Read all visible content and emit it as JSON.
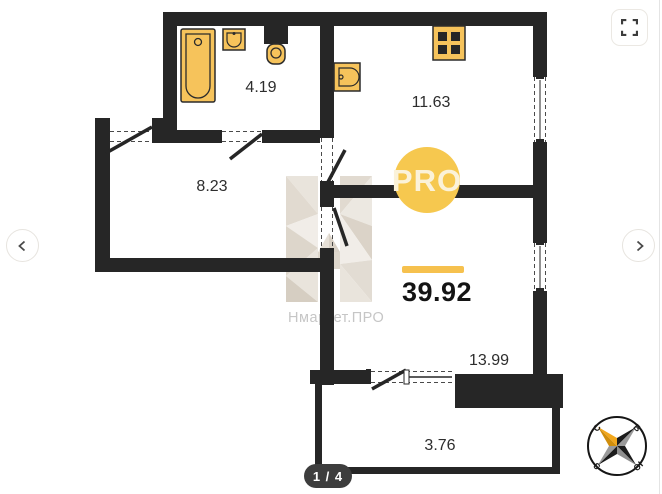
{
  "viewer": {
    "page_indicator": "1 / 4",
    "icons": {
      "fullscreen": "fullscreen-expand-icon",
      "prev": "chevron-left-icon",
      "next": "chevron-right-icon",
      "compass": "compass-rose-icon"
    }
  },
  "floorplan": {
    "total_area": "39.92",
    "rooms": [
      {
        "name": "bathroom",
        "area": "4.19"
      },
      {
        "name": "kitchen",
        "area": "11.63"
      },
      {
        "name": "hallway",
        "area": "8.23"
      },
      {
        "name": "living-room",
        "area": "13.99"
      },
      {
        "name": "balcony",
        "area": "3.76"
      }
    ],
    "watermark": {
      "badge": "PRO",
      "brand": "Нмаркет.ПРО"
    },
    "compass": {
      "north": "С",
      "east": "В",
      "south": "Ю",
      "west": "З"
    },
    "colors": {
      "wall": "#262626",
      "fixture_fill": "#f6c35b",
      "accent_bar": "#f6c14e",
      "badge_bg": "#f6c84f",
      "watermark_text": "#c6c6c6"
    }
  }
}
